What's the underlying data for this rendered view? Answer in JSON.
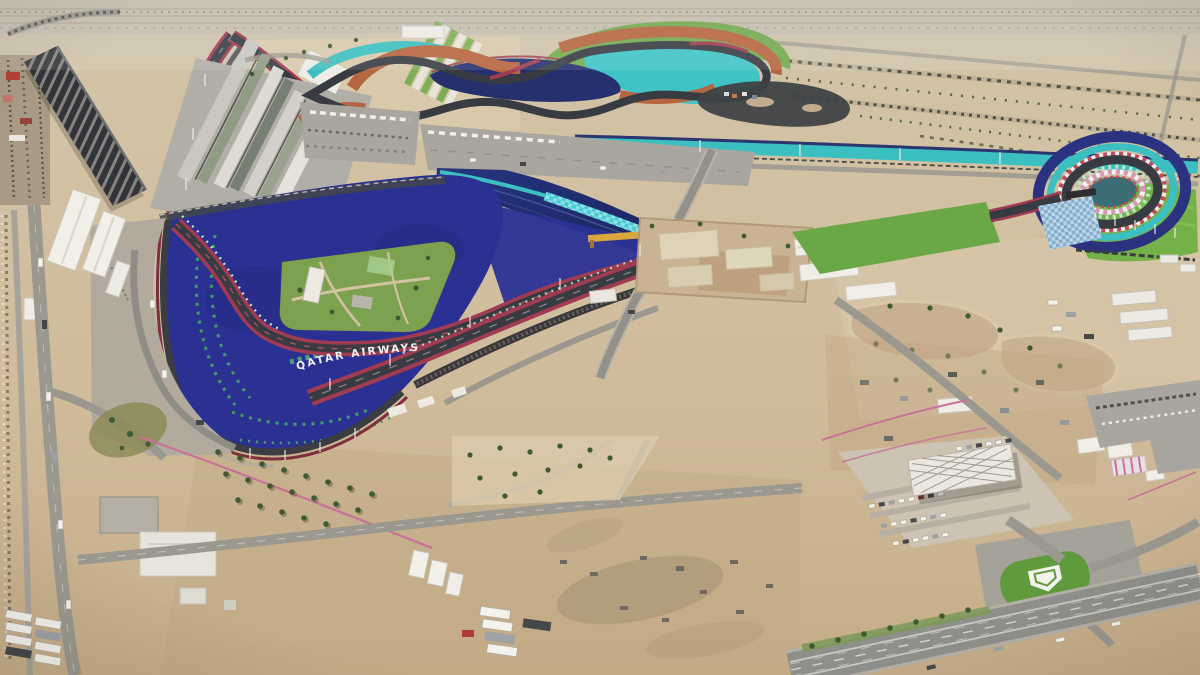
{
  "scene": {
    "kind": "aerial-photograph",
    "subject": "aerial view of a desert motorsport circuit complex",
    "sponsor_text": "QATAR AIRWAYS"
  },
  "palette": {
    "sand": "#cdb897",
    "sand-light": "#dbcbad",
    "sand-dark": "#c0a783",
    "distant-ground": "#c7bfaf",
    "road": "#9a988f",
    "parking-lot": "#a8a69f",
    "asphalt": "#383b42",
    "runoff-blue": "#2a3193",
    "water-navy": "#1e2a6d",
    "runoff-teal": "#3cbfc0",
    "runoff-orange": "#b5653f",
    "track-red": "#a03b52",
    "maroon": "#7e2f3e",
    "grass": "#6aa746",
    "grass-bright": "#74b148",
    "mint-curb": "#bfe3c4",
    "structure-white": "#eceae3",
    "fence-pink": "#c9729a",
    "tree-green": "#3f5a33",
    "gantry-yellow": "#d9a73e"
  }
}
